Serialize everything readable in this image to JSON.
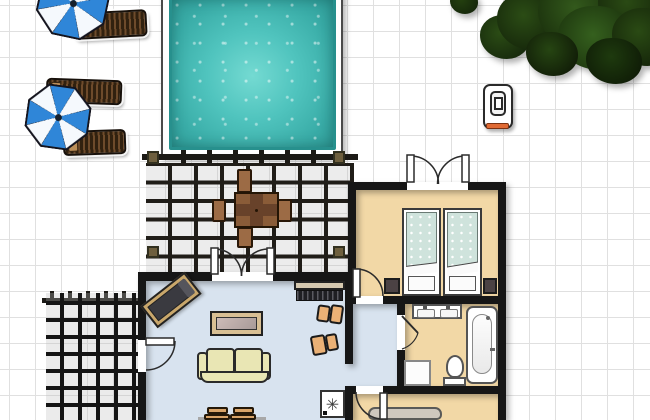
{
  "scene": {
    "type": "floor-plan",
    "title": "house floor plan with pool and garden",
    "stove_symbol": "✳",
    "outdoor": {
      "pool": {
        "label": "swimming-pool",
        "water_color": "#45bdb8",
        "deck_color": "#ffffff"
      },
      "umbrella_count": 2,
      "umbrella_colors": [
        "#2f86d8",
        "#f5f9fd"
      ],
      "sun_lounger_count": 3,
      "tree_count": 1,
      "grill_count": 1,
      "pergola_dining": {
        "tables": 1,
        "chairs": 4,
        "wood_color": "#8a5c38"
      },
      "trellis_count": 1
    },
    "rooms": [
      {
        "name": "living-room",
        "floor_color": "#d8e3ef",
        "furniture": [
          "chaise-longue",
          "coffee-table",
          "sofa",
          "sideboard",
          "armchair",
          "armchair",
          "dining-chair",
          "dining-chair",
          "stove"
        ]
      },
      {
        "name": "bedroom",
        "floor_color": "#f2d8a6",
        "furniture": [
          "bed",
          "bed",
          "nightstand",
          "nightstand"
        ],
        "doors": [
          "french-doors",
          "interior-door"
        ]
      },
      {
        "name": "bathroom",
        "floor_color": "#f2d8a6",
        "furniture": [
          "double-sink-vanity",
          "bathtub",
          "toilet",
          "cabinet"
        ],
        "doors": [
          "interior-door"
        ]
      },
      {
        "name": "lower-room",
        "floor_color": "#f2d8a6",
        "furniture": [
          "bed-headboard"
        ],
        "doors": [
          "interior-door"
        ]
      }
    ],
    "palette": {
      "wall": "#161616",
      "grid_line": "#e0e0e0",
      "pool_water": "#45bdb8",
      "living_floor": "#d8e3ef",
      "tan_floor": "#f2d8a6",
      "sofa": "#e9e6b4",
      "armchair": "#eab176",
      "bed_blanket": "#cfe3dc",
      "tree_green": "#2b4c15",
      "grill_accent": "#e06a34"
    }
  }
}
